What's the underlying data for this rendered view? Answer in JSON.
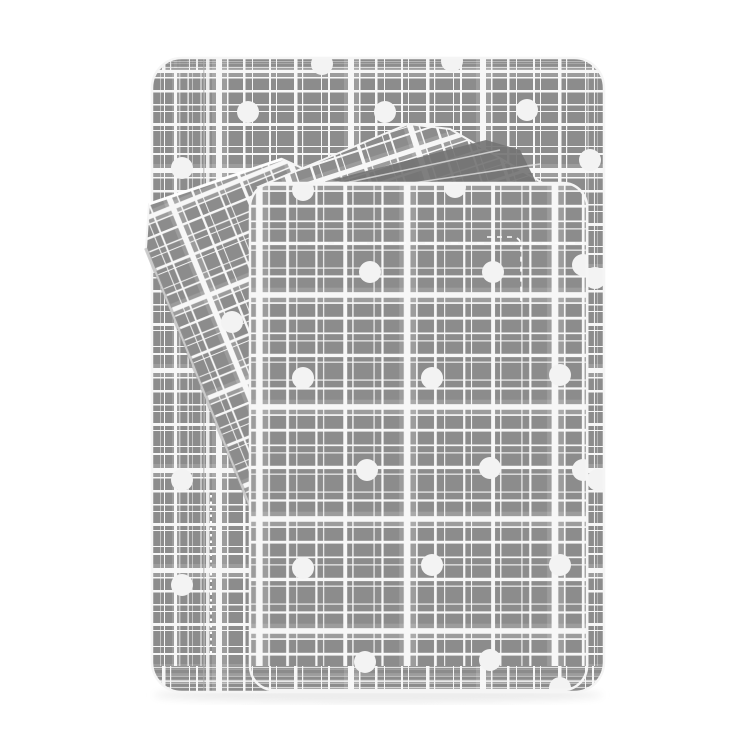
{
  "meta": {
    "description": "Product photo of a folded grey and white plaid sheet set with white polka dots: a large folded sheet, a tilted pillowcase at the left, a diagonal folded flap at the top, and a front folded panel, on a plain white background",
    "width": 750,
    "height": 750
  },
  "palette": {
    "background": "#ffffff",
    "fabric_base": "#8c8c8c",
    "fabric_band": "#9c9c9c",
    "fabric_band_cross": "#aaaaaa",
    "line_white": "#f7f7f7",
    "edge_white": "#f5f5f5",
    "dark_fold": "#747474",
    "fold_shadow": "#989898",
    "dot_white": "#f3f3f3",
    "seam_white": "#fdfdfd",
    "fold_line_gray": "#adadad",
    "shadow": "#ececec"
  },
  "pattern": {
    "tile_w": 132,
    "tile_h": 100,
    "v_band": {
      "x": 80,
      "w": 16
    },
    "h_band": {
      "y": 64,
      "h": 14
    },
    "v_lines": [
      {
        "x": 5,
        "w": 2
      },
      {
        "x": 12,
        "w": 1
      },
      {
        "x": 30,
        "w": 3.5
      },
      {
        "x": 38,
        "w": 1.2
      },
      {
        "x": 57,
        "w": 1
      },
      {
        "x": 64,
        "w": 2
      },
      {
        "x": 84,
        "w": 6
      },
      {
        "x": 95,
        "w": 1.5
      },
      {
        "x": 111,
        "w": 2.5
      },
      {
        "x": 120,
        "w": 1
      }
    ],
    "h_lines": [
      {
        "y": 4,
        "w": 1.5
      },
      {
        "y": 11,
        "w": 1
      },
      {
        "y": 23,
        "w": 3
      },
      {
        "y": 30,
        "w": 1
      },
      {
        "y": 46,
        "w": 1
      },
      {
        "y": 53,
        "w": 2
      },
      {
        "y": 68,
        "w": 5
      },
      {
        "y": 77,
        "w": 1.5
      },
      {
        "y": 90,
        "w": 2.5
      }
    ]
  },
  "pattern_variants": {
    "plaidBack": "",
    "plaidFront": "translate(14,-8) scale(1.12)",
    "plaidLeft": "scale(0.5,1)",
    "plaidRight": "scale(0.38,1)",
    "plaidDense": "scale(1,0.3)",
    "plaidPillow": "rotate(-22) scale(0.95)",
    "plaidFlap": "rotate(-18)"
  },
  "layers": {
    "back_sheet": {
      "x": 152,
      "y": 58,
      "w": 452,
      "h": 634,
      "rx": 30,
      "left_band_w": 56,
      "right_band_w": 19,
      "top_band_h": 12,
      "bottom_band_h": 26,
      "fold_line_x": 206
    },
    "pillowcase": {
      "points": "149,204 282,159 302,168 302,430 261,534 146,248",
      "top_edge": [
        [
          149,
          204
        ],
        [
          282,
          159
        ]
      ],
      "shade_edge": [
        [
          146,
          248
        ],
        [
          261,
          534
        ]
      ]
    },
    "flap": {
      "points": "258,187 408,124 450,129 565,196 585,215 585,236 300,236",
      "wedge": "332,180 486,140 520,150 540,190 400,196",
      "wedge_lines": [
        [
          340,
          184,
          500,
          150
        ],
        [
          346,
          193,
          540,
          164
        ]
      ]
    },
    "front_sheet": {
      "x": 250,
      "y": 183,
      "w": 337,
      "h": 507,
      "rx": 24,
      "bottom_band_h": 24
    }
  },
  "dots": {
    "radius": 11,
    "back": [
      [
        248,
        112
      ],
      [
        322,
        64
      ],
      [
        385,
        112
      ],
      [
        452,
        61
      ],
      [
        527,
        110
      ],
      [
        590,
        160
      ],
      [
        182,
        168
      ],
      [
        182,
        480
      ],
      [
        182,
        585
      ],
      [
        595,
        278
      ],
      [
        598,
        480
      ]
    ],
    "pillowcase": [
      [
        232,
        322
      ]
    ],
    "front": [
      [
        303,
        190
      ],
      [
        455,
        187
      ],
      [
        370,
        272
      ],
      [
        493,
        272
      ],
      [
        583,
        265
      ],
      [
        303,
        378
      ],
      [
        432,
        378
      ],
      [
        560,
        375
      ],
      [
        367,
        470
      ],
      [
        490,
        468
      ],
      [
        583,
        470
      ],
      [
        303,
        568
      ],
      [
        432,
        565
      ],
      [
        560,
        565
      ],
      [
        365,
        662
      ],
      [
        490,
        660
      ],
      [
        560,
        688
      ]
    ]
  },
  "stitches": {
    "dash_line": {
      "y": 243,
      "x1": 308,
      "x2": 583
    },
    "corner": {
      "x": 487,
      "y": 237,
      "len_h": 26,
      "len_v": 55
    },
    "seam": {
      "x": 211,
      "y1": 495,
      "y2": 655
    }
  },
  "shadow": {
    "cx": 378,
    "cy": 695,
    "rx": 225,
    "ry": 8
  }
}
